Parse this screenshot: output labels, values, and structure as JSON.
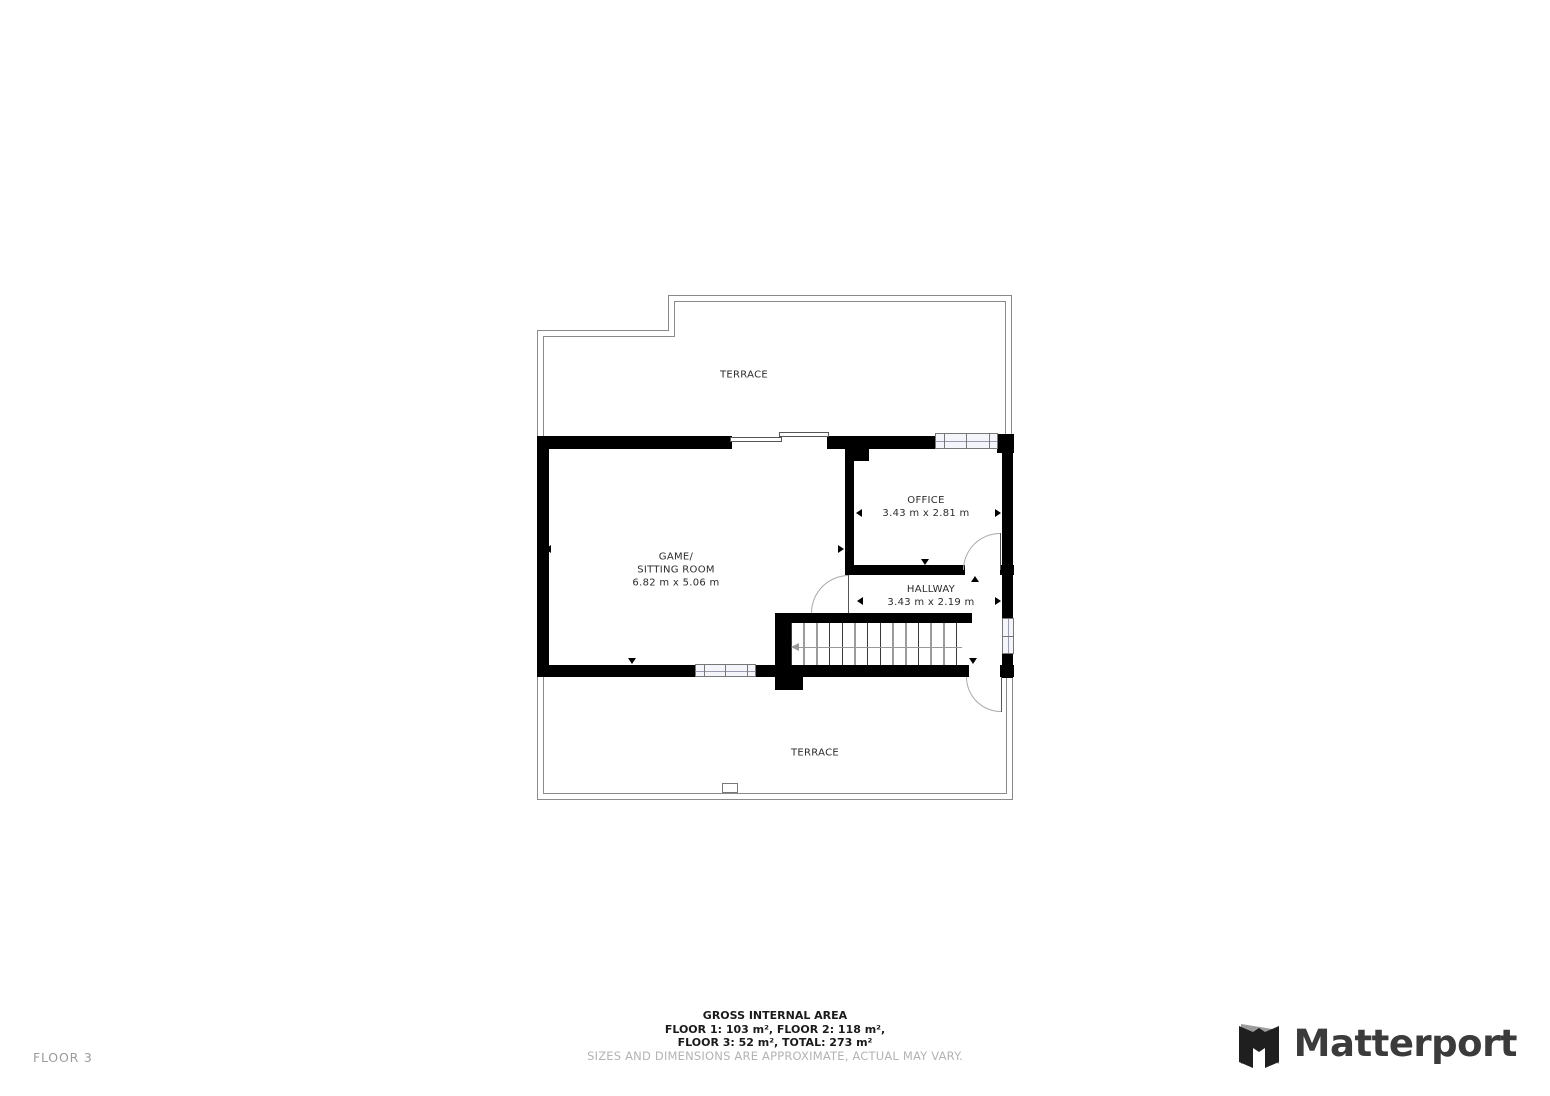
{
  "meta": {
    "floor_label": "FLOOR 3",
    "brand": "Matterport"
  },
  "rooms": {
    "terrace_top": {
      "name": "TERRACE"
    },
    "game_sitting": {
      "name_line1": "GAME/",
      "name_line2": "SITTING ROOM",
      "dims": "6.82 m x 5.06 m"
    },
    "office": {
      "name": "OFFICE",
      "dims": "3.43 m x 2.81 m"
    },
    "hallway": {
      "name": "HALLWAY",
      "dims": "3.43 m x 2.19 m"
    },
    "terrace_bottom": {
      "name": "TERRACE"
    }
  },
  "footer": {
    "title": "GROSS INTERNAL AREA",
    "areas_line1": "FLOOR 1: 103 m², FLOOR 2: 118 m²,",
    "areas_line2": "FLOOR 3: 52 m², TOTAL: 273 m²",
    "disclaimer": "SIZES AND DIMENSIONS ARE APPROXIMATE, ACTUAL MAY VARY."
  },
  "icons": {
    "matterport_logo": "matterport-cube-m-icon"
  },
  "colors": {
    "wall": "#000000",
    "terrace_line": "#8a8a8a",
    "window_fill": "#f4f4fb",
    "label_text": "#2b2b2b",
    "muted_text": "#b3b3b3",
    "floor_tag_text": "#9b9b9b",
    "brand_text": "#3b3b3b"
  }
}
